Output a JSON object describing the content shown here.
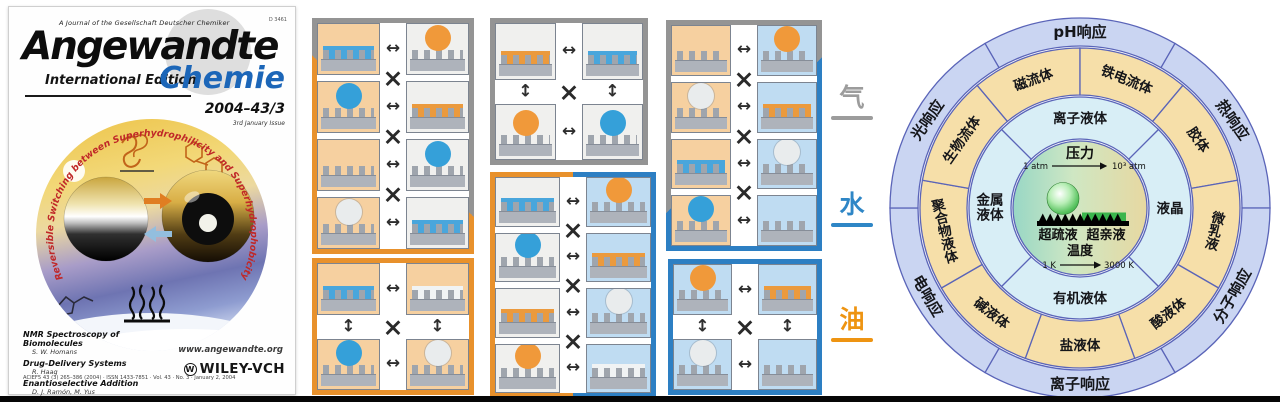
{
  "left_panel": {
    "journal_note": "A Journal of the Gesellschaft Deutscher Chemiker",
    "postal_code": "D 3461",
    "title": "Angewandte",
    "edition": "International Edition",
    "title_accent": "Chemie",
    "issue": "2004–43/3",
    "issue_note": "3rd January Issue",
    "cover_arc_text": "Reversible Switching between Superhydrophilicity and Superhydrophobicity",
    "articles": [
      {
        "title": "NMR Spectroscopy of Biomolecules",
        "authors": "S. W. Homans"
      },
      {
        "title": "Drug-Delivery Systems",
        "authors": "R. Haag"
      },
      {
        "title": "Enantioselective Addition",
        "authors": "D. J. Ramón, M. Yus"
      }
    ],
    "website": "www.angewandte.org",
    "imprint": "ACIEF5 43 (3) 265–386 (2004) · ISSN 1433-7851 · Vol. 43 · No. 3 · January 2, 2004",
    "publisher": "WILEY-VCH",
    "publisher_mark": "W"
  },
  "middle_panel": {
    "media": {
      "gas": "气",
      "water": "水",
      "oil": "油"
    },
    "blocks": [
      {
        "id": "oil-gas",
        "x": 12,
        "y": 18,
        "w": 162,
        "h": 236,
        "layout": "rows4",
        "frame": "oil-gray",
        "left_medium": "oil",
        "right_medium": "air",
        "rows": [
          [
            "blue-film",
            "orange-droplet"
          ],
          [
            "blue-droplet",
            "orange-film"
          ],
          [
            "bare",
            "blue-droplet"
          ],
          [
            "white-droplet",
            "blue-film"
          ]
        ]
      },
      {
        "id": "oil-oil",
        "x": 12,
        "y": 258,
        "w": 162,
        "h": 137,
        "layout": "grid2",
        "frame": "oil",
        "left_medium": "oil",
        "right_medium": "oil",
        "rows": [
          [
            "blue-film",
            "white-film"
          ],
          [
            "blue-droplet",
            "white-droplet"
          ]
        ]
      },
      {
        "id": "gas-gas",
        "x": 190,
        "y": 18,
        "w": 158,
        "h": 147,
        "layout": "grid2",
        "frame": "gray",
        "left_medium": "air",
        "right_medium": "air",
        "rows": [
          [
            "orange-film",
            "blue-film"
          ],
          [
            "orange-droplet",
            "blue-droplet"
          ]
        ]
      },
      {
        "id": "gas-water",
        "x": 190,
        "y": 172,
        "w": 166,
        "h": 226,
        "layout": "rows4",
        "frame": "oil-water",
        "left_medium": "air",
        "right_medium": "water",
        "rows": [
          [
            "blue-film",
            "orange-droplet"
          ],
          [
            "blue-droplet",
            "orange-film"
          ],
          [
            "orange-film",
            "white-droplet"
          ],
          [
            "orange-droplet",
            "white-film"
          ]
        ]
      },
      {
        "id": "oil-water",
        "x": 366,
        "y": 20,
        "w": 156,
        "h": 231,
        "layout": "rows4",
        "frame": "gray-water",
        "left_medium": "oil",
        "right_medium": "water",
        "rows": [
          [
            "bare",
            "orange-droplet"
          ],
          [
            "white-droplet",
            "orange-film"
          ],
          [
            "blue-film",
            "white-droplet"
          ],
          [
            "blue-droplet",
            "bare"
          ]
        ]
      },
      {
        "id": "water-water",
        "x": 368,
        "y": 259,
        "w": 154,
        "h": 136,
        "layout": "grid2",
        "frame": "water",
        "left_medium": "water",
        "right_medium": "water",
        "rows": [
          [
            "orange-droplet",
            "orange-film"
          ],
          [
            "white-droplet",
            "bare"
          ]
        ]
      }
    ]
  },
  "right_panel": {
    "stroke": "#5a64b8",
    "rings": [
      {
        "id": "outer",
        "r0": 162,
        "r1": 190,
        "fill": "#cad5f2",
        "label_r": 176,
        "font_size": 15,
        "sectors": [
          {
            "label": "pH响应",
            "start": 330,
            "end": 390,
            "rot": 0
          },
          {
            "label": "热响应",
            "start": 30,
            "end": 90,
            "rot": 55
          },
          {
            "label": "分子响应",
            "start": 90,
            "end": 150,
            "rot": -60
          },
          {
            "label": "离子响应",
            "start": 150,
            "end": 210,
            "rot": 0
          },
          {
            "label": "电响应",
            "start": 210,
            "end": 270,
            "rot": 60
          },
          {
            "label": "光响应",
            "start": 270,
            "end": 330,
            "rot": -55
          }
        ]
      },
      {
        "id": "middle",
        "r0": 113,
        "r1": 160,
        "fill": "#f6dfa9",
        "label_r": 137,
        "font_size": 13.5,
        "sectors": [
          {
            "label": "磁流体",
            "start": 320,
            "end": 360,
            "rot": -20
          },
          {
            "label": "铁电流体",
            "start": 0,
            "end": 40,
            "rot": 22
          },
          {
            "label": "胶体",
            "start": 40,
            "end": 80,
            "rot": 55
          },
          {
            "label": "微乳液",
            "start": 80,
            "end": 120,
            "rot": "v14"
          },
          {
            "label": "酸液体",
            "start": 120,
            "end": 160,
            "rot": -38
          },
          {
            "label": "盐液体",
            "start": 160,
            "end": 200,
            "rot": 0
          },
          {
            "label": "碱液体",
            "start": 200,
            "end": 240,
            "rot": 38
          },
          {
            "label": "聚合物液体",
            "start": 240,
            "end": 280,
            "rot": "v-14"
          },
          {
            "label": "生物流体",
            "start": 280,
            "end": 320,
            "rot": -55
          }
        ]
      },
      {
        "id": "inner",
        "r0": 69,
        "r1": 111,
        "fill": "#d8eef6",
        "label_r": 90,
        "font_size": 13.5,
        "sectors": [
          {
            "label": "离子液体",
            "start": 315,
            "end": 405,
            "rot": 0
          },
          {
            "label": "液晶",
            "start": 45,
            "end": 135,
            "rot": 0
          },
          {
            "label": "有机液体",
            "start": 135,
            "end": 225,
            "rot": 0
          },
          {
            "label": "金属液体",
            "start": 225,
            "end": 315,
            "rot": 0,
            "lines": [
              "金属",
              "液体"
            ]
          }
        ]
      }
    ],
    "center": {
      "radius": 67,
      "top_label": "压力",
      "top_scale_left": "1 atm",
      "top_scale_right": "10³ atm",
      "caption_left": "超疏液",
      "caption_right": "超亲液",
      "bottom_label": "温度",
      "bottom_scale_left": "1 K",
      "bottom_scale_right": "3000 K"
    }
  }
}
